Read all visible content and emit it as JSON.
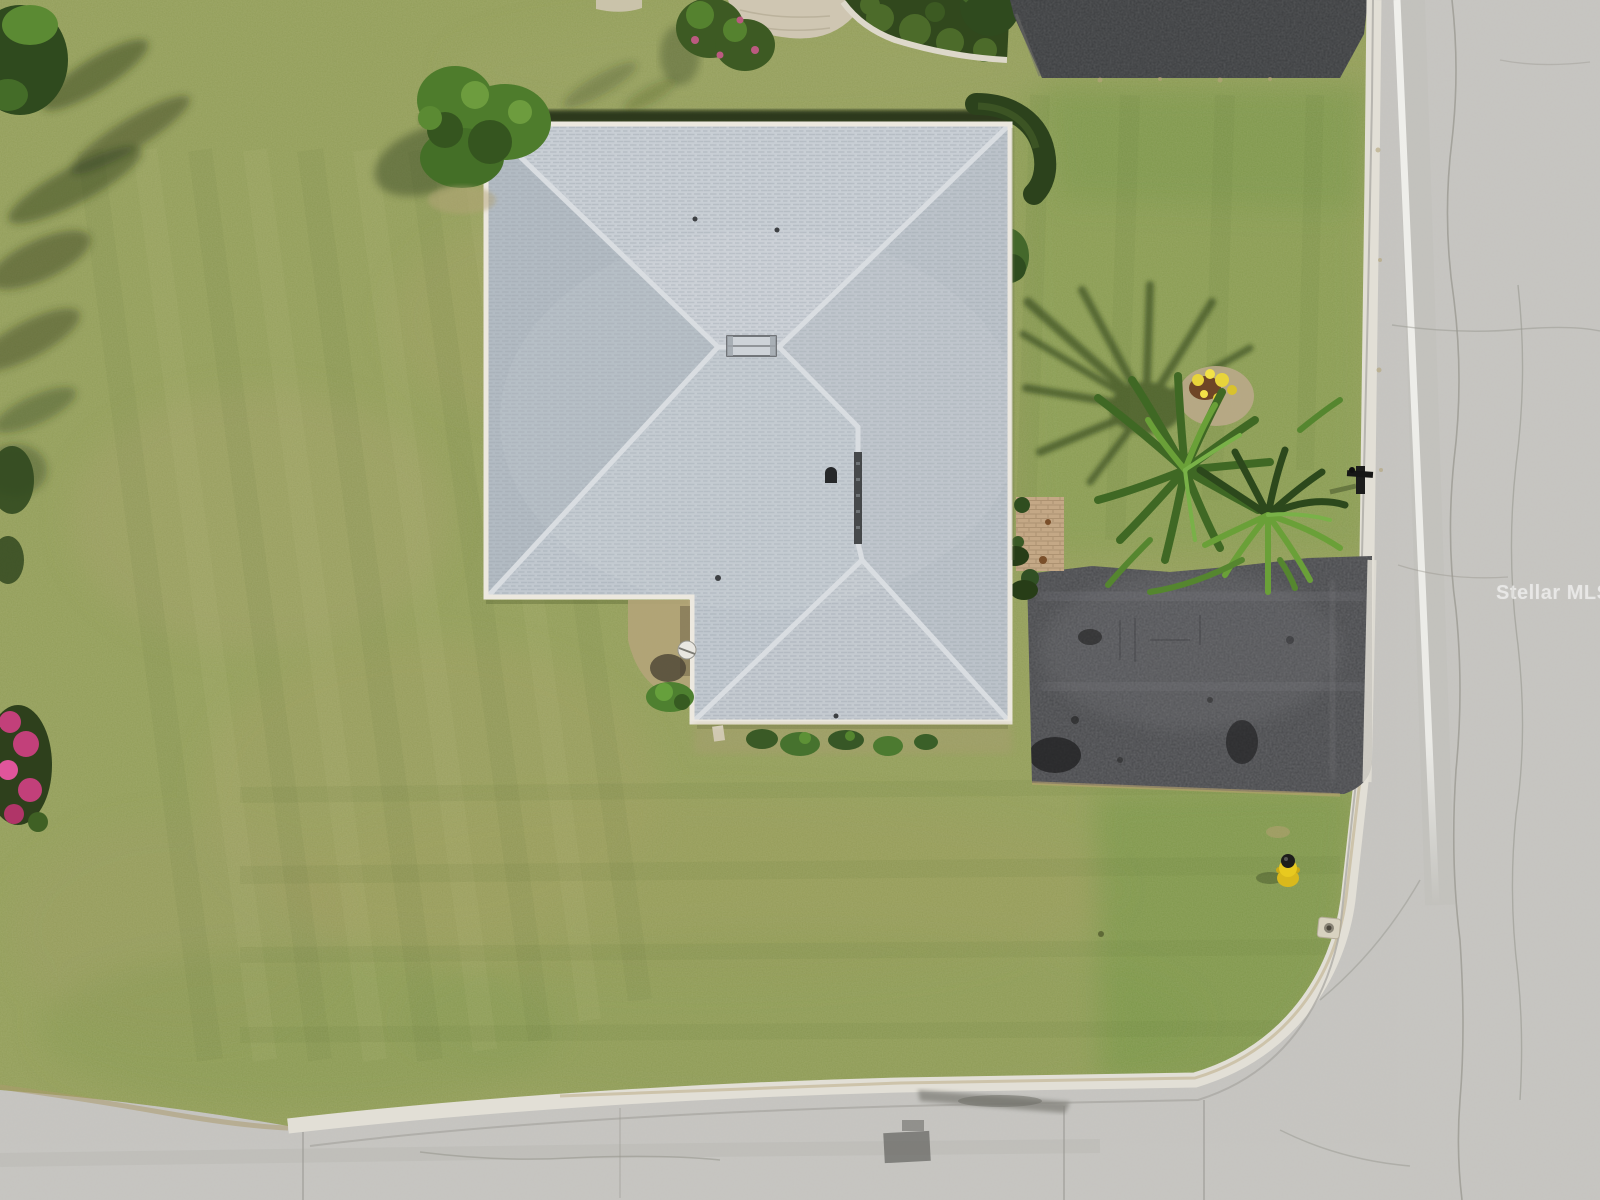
{
  "watermark": {
    "label": "Stellar MLS"
  },
  "colors": {
    "lawn": "#95a05a",
    "lawnDeep": "#6e9340",
    "roofBase": "#c1c8cf",
    "roofTop": "#c9cfd5",
    "roofWest": "#b1bac2",
    "roofEast": "#bbc2c9",
    "fascia": "#ece8df",
    "ridge": "#d9dde1",
    "hedge": "#2c421c",
    "tree": "#2f4a1e",
    "shrub": "#4e7c2c",
    "palmDark": "#3f6824",
    "palmLight": "#6aa038",
    "asphalt": "#47484b",
    "asphaltDark": "#3b3d3f",
    "concrete": "#c7c6c2",
    "curb": "#e2dfd6",
    "stripe": "#f2f2ee",
    "dirt": "#b3a478",
    "pavers": "#cfc6b2",
    "paverPad": "#c4a886",
    "mulch": "#b8a987",
    "hydrantYellow": "#e8c91f",
    "pinkFlower": "#c2407a",
    "yellowFlower": "#e8d43a",
    "shadowGreen": "#2c3a1a"
  }
}
